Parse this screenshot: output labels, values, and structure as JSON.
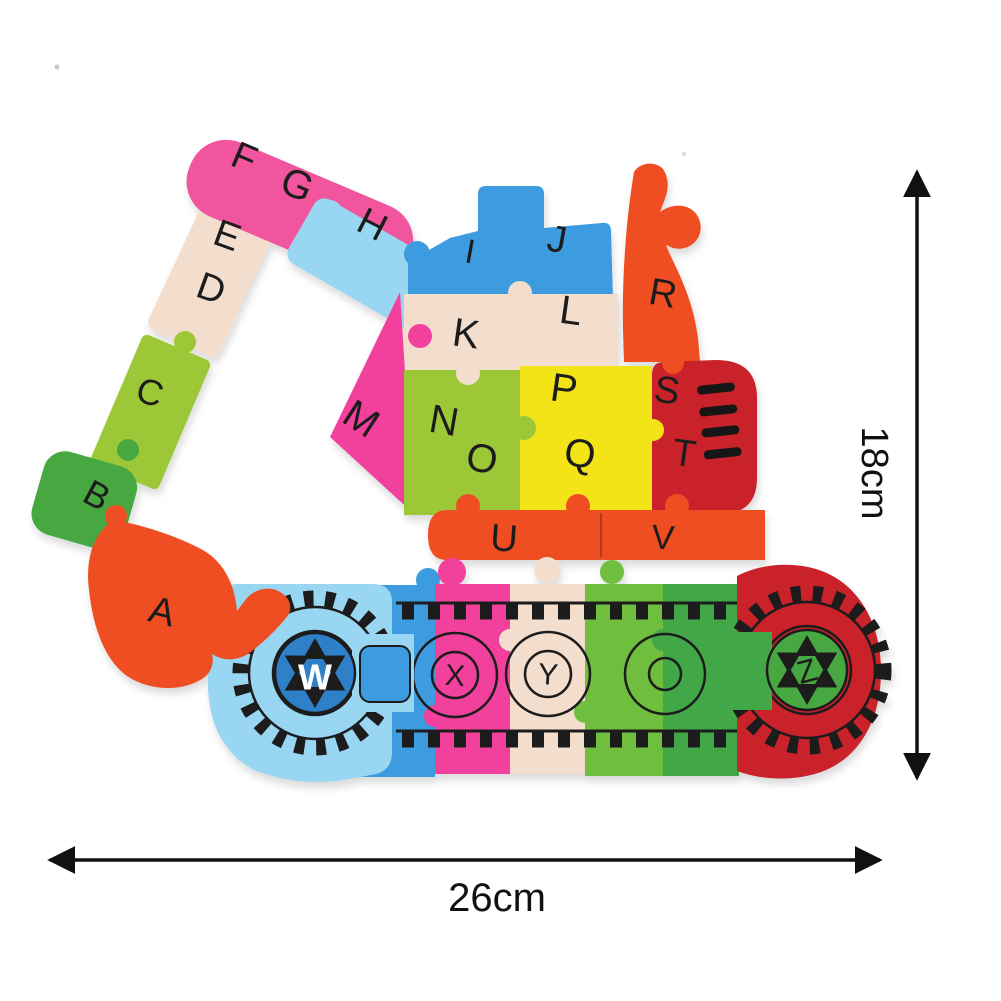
{
  "product": {
    "description": "wooden alphabet excavator jigsaw puzzle",
    "letters": [
      "A",
      "B",
      "C",
      "D",
      "E",
      "F",
      "G",
      "H",
      "I",
      "J",
      "K",
      "L",
      "M",
      "N",
      "O",
      "P",
      "Q",
      "R",
      "S",
      "T",
      "U",
      "V",
      "W",
      "X",
      "Y",
      "Z"
    ],
    "dimensions": {
      "height_label": "18cm",
      "width_label": "26cm"
    },
    "colors": {
      "pink": "#F0549E",
      "hot_pink": "#F2419D",
      "cream": "#F3DECE",
      "yellow_green": "#9CC838",
      "green": "#47A843",
      "track_green_light": "#6FBE3C",
      "track_green_dark": "#43A846",
      "orange_red": "#EF4E23",
      "light_blue": "#98D6F2",
      "blue": "#3D9BDF",
      "hub_blue": "#2F80C8",
      "yellow": "#F2E417",
      "dark_red": "#C9222B",
      "line_black": "#1C1C1C"
    }
  }
}
